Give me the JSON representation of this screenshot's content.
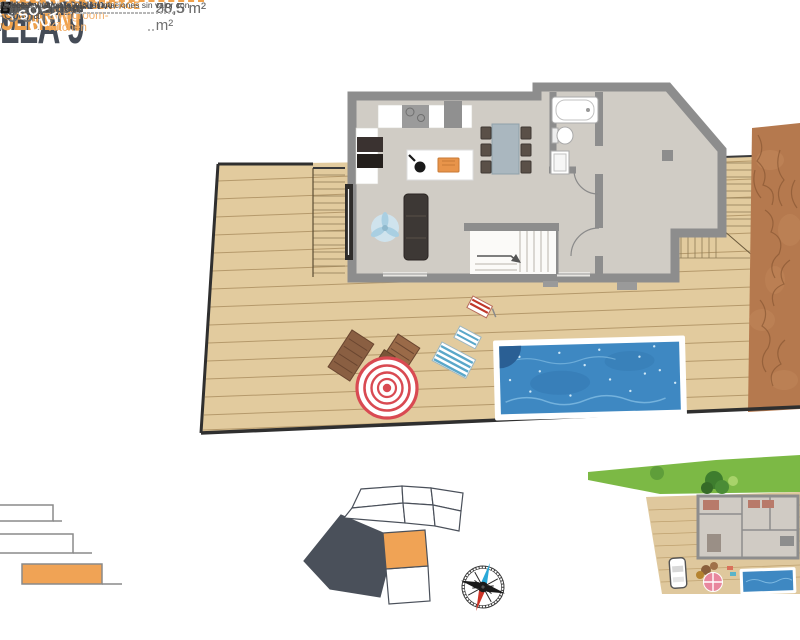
{
  "panel": {
    "villa": "LLA 9",
    "floor_es": "TANO",
    "floor_en": "SEMENT",
    "built": {
      "label_es": "ERFICIE CONSTRUIDA",
      "label_en": "D SURFACE",
      "value": "96 m²"
    },
    "rooms": [
      {
        "es": "-Cocina /",
        "en": "Livingroom-Kitchen",
        "value": "50,5 m²"
      },
      {
        "es": "ación /",
        "en": "Room",
        "value": "28,5 m²"
      },
      {
        "es": "4 /",
        "en": "Bathroom 4",
        "value": "5 m²"
      }
    ],
    "total": {
      "label_es": "RFICIE ÚTIL TOTAL",
      "label_en": "L USEFUL FLOOR SURFACE",
      "value": "84 m²"
    }
  },
  "plan": {
    "kitchen": "Kitchen",
    "living_room": "Living Room",
    "bathroom_line1": "Bathroom",
    "bathroom_line2": "4",
    "room": "Room",
    "stairs": "Stairs"
  },
  "legend": {
    "items": [
      {
        "label": "Solarium"
      },
      {
        "label": "Ground Floor"
      },
      {
        "label": "Basement"
      }
    ]
  },
  "plot_map": {
    "numbers": [
      "5",
      "7",
      "11",
      "6",
      "8",
      "12",
      "9",
      "10"
    ],
    "sold_line1": "SOLD",
    "sold_line2": "OUT",
    "highlighted_plot": "9"
  },
  "compass": {
    "east": "E",
    "south": "S"
  },
  "disclaimer": {
    "line1": "*Diseño artístico sujeto a variaciones sin valor con",
    "line2": "Muebles y paneles solares no i"
  },
  "colors": {
    "accent_orange": "#F0A24C",
    "dark_slate": "#454C57",
    "wall_gray": "#8D8D8D",
    "deck_tan": "#E2CB9E",
    "pool_blue": "#3E88C2",
    "dirt_brown": "#B5794E",
    "sold_out_bg": "#4A505A",
    "umbrella_red": "#D94A52",
    "highlight_plot": "#F0A355",
    "value_gray": "#707070"
  }
}
